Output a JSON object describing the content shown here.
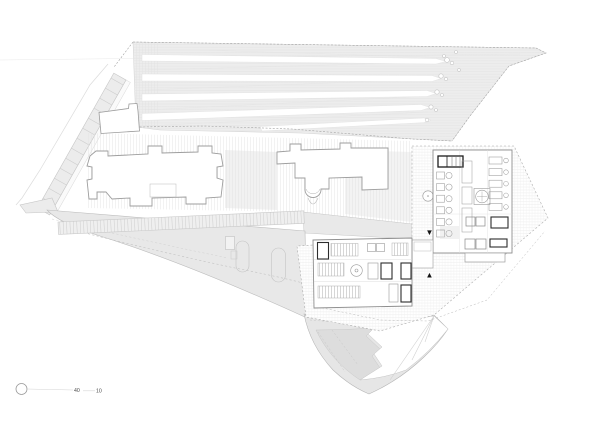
{
  "scale_bar": {
    "label_outer": "40",
    "label_inner": "10"
  },
  "markers": {
    "entrance_down": "▼",
    "entrance_up": "▲"
  },
  "icons": {
    "scale_origin": "circle-icon",
    "entrance_down": "triangle-down-icon",
    "entrance_up": "triangle-up-icon"
  },
  "colors": {
    "bg": "#ffffff",
    "field": "#ededed",
    "slope": "#e8e8e8",
    "tip": "#e6e6e6",
    "tip_dark": "#dddddd",
    "road": "#ececec",
    "pergola": "#efefef",
    "strip": "#e9e9e9",
    "building": "#ffffff",
    "line_faint": "#e2e2e2",
    "line_light": "#c9c9c9",
    "line_mid": "#9e9e9e",
    "wall": "#8e8e8e",
    "dark": "#1b1b1b",
    "dash": "#a3a3a3",
    "text": "#4a4a4a"
  }
}
